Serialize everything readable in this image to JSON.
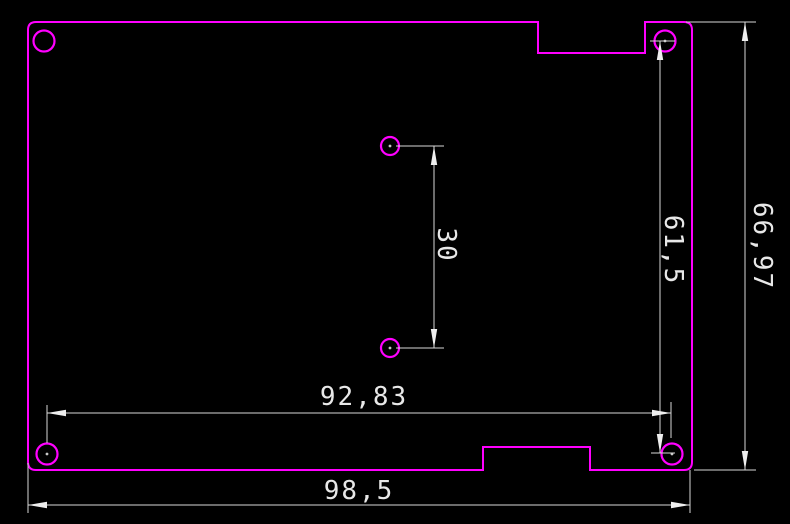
{
  "drawing": {
    "type": "cad-board-outline-with-dimensions",
    "colors": {
      "background": "#000000",
      "board_outline": "#ff00ff",
      "dimension_lines": "#d9d9d9",
      "dimension_text": "#e8e8e8"
    },
    "dims": {
      "center_hole_pitch": "30",
      "right_hole_span": "61,5",
      "overall_height": "66,97",
      "bottom_hole_span": "92,83",
      "overall_width": "98,5"
    }
  }
}
